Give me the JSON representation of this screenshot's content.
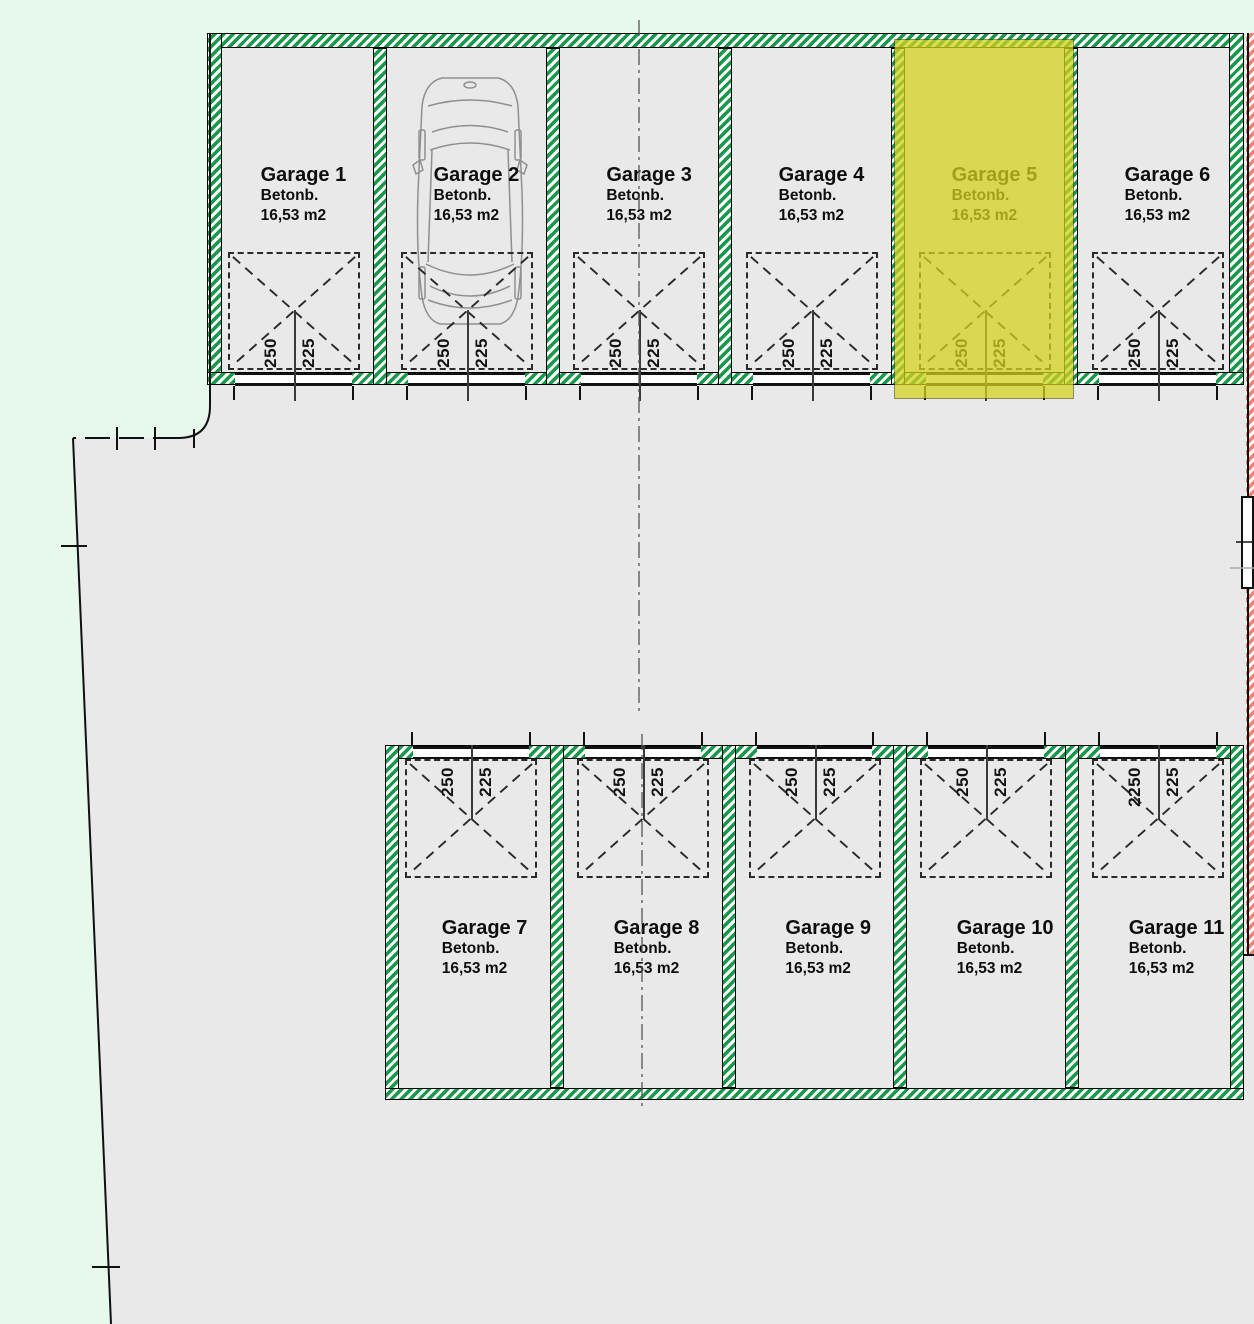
{
  "plan": {
    "floor_label": "Betonb.",
    "area_label": "16,53 m2",
    "highlighted_garage": "Garage 5"
  },
  "colors": {
    "site_background": "#e7f8ec",
    "paved_area": "#e9e9e9",
    "wall_hatch_green": "#17984b",
    "boundary_hatch_red": "#f2816f",
    "highlight_yellow": "#d4d11e",
    "line_black": "#111111"
  },
  "garages": [
    {
      "name": "Garage 1",
      "floor": "Betonb.",
      "area": "16,53 m2",
      "dim_width": "250",
      "dim_depth": "225",
      "row": "top",
      "highlighted": false
    },
    {
      "name": "Garage 2",
      "floor": "Betonb.",
      "area": "16,53 m2",
      "dim_width": "250",
      "dim_depth": "225",
      "row": "top",
      "highlighted": false,
      "has_car": true
    },
    {
      "name": "Garage 3",
      "floor": "Betonb.",
      "area": "16,53 m2",
      "dim_width": "250",
      "dim_depth": "225",
      "row": "top",
      "highlighted": false
    },
    {
      "name": "Garage 4",
      "floor": "Betonb.",
      "area": "16,53 m2",
      "dim_width": "250",
      "dim_depth": "225",
      "row": "top",
      "highlighted": false
    },
    {
      "name": "Garage 5",
      "floor": "Betonb.",
      "area": "16,53 m2",
      "dim_width": "250",
      "dim_depth": "225",
      "row": "top",
      "highlighted": true
    },
    {
      "name": "Garage 6",
      "floor": "Betonb.",
      "area": "16,53 m2",
      "dim_width": "250",
      "dim_depth": "225",
      "row": "top",
      "highlighted": false
    },
    {
      "name": "Garage 7",
      "floor": "Betonb.",
      "area": "16,53 m2",
      "dim_width": "250",
      "dim_depth": "225",
      "row": "bottom",
      "highlighted": false
    },
    {
      "name": "Garage 8",
      "floor": "Betonb.",
      "area": "16,53 m2",
      "dim_width": "250",
      "dim_depth": "225",
      "row": "bottom",
      "highlighted": false
    },
    {
      "name": "Garage 9",
      "floor": "Betonb.",
      "area": "16,53 m2",
      "dim_width": "250",
      "dim_depth": "225",
      "row": "bottom",
      "highlighted": false
    },
    {
      "name": "Garage 10",
      "floor": "Betonb.",
      "area": "16,53 m2",
      "dim_width": "250",
      "dim_depth": "225",
      "row": "bottom",
      "highlighted": false
    },
    {
      "name": "Garage 11",
      "floor": "Betonb.",
      "area": "16,53 m2",
      "dim_width": "2250",
      "dim_depth": "225",
      "row": "bottom",
      "highlighted": false
    }
  ]
}
